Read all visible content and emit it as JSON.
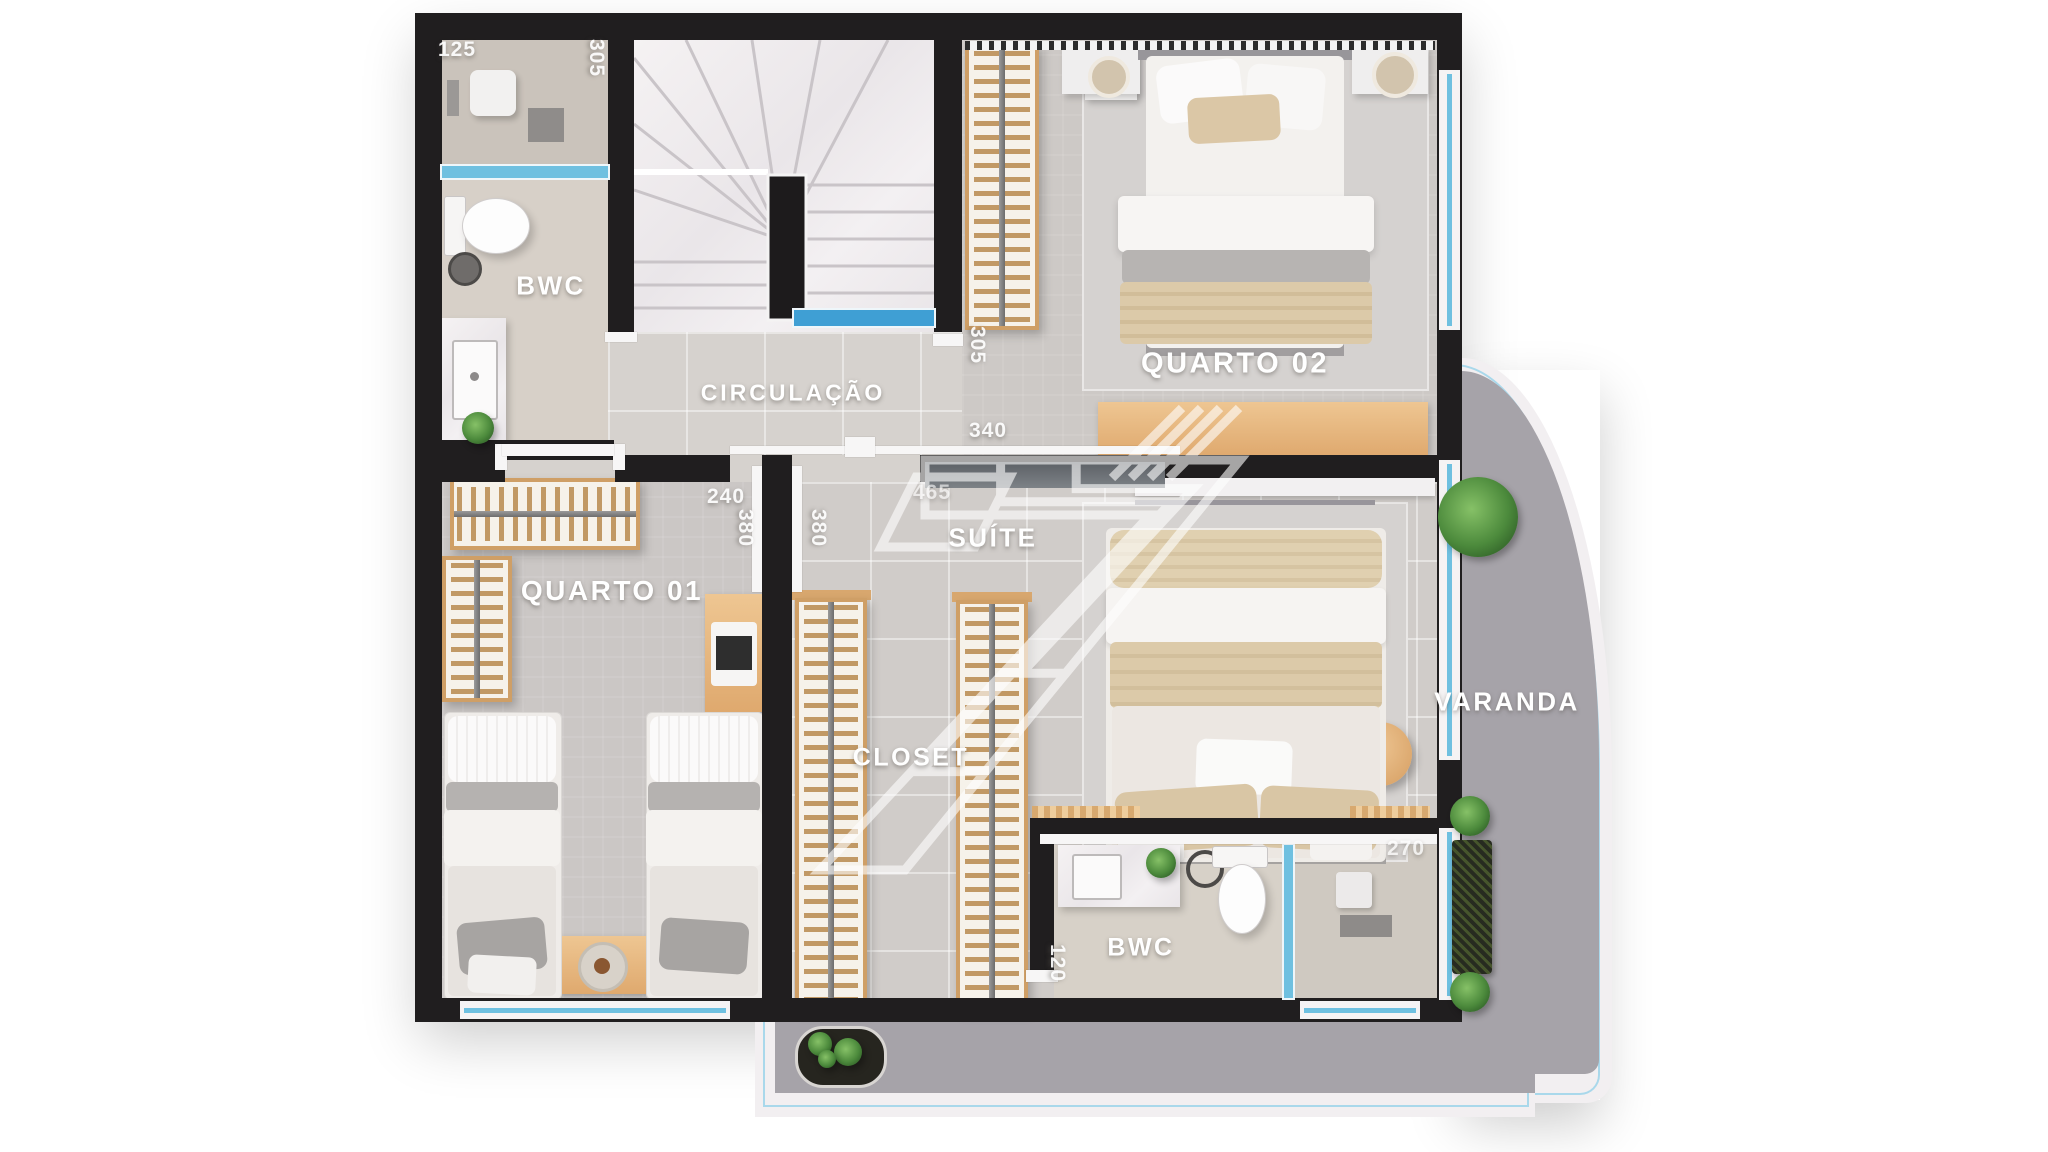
{
  "watermark_glyph": "7",
  "rooms": [
    {
      "key": "bwc_top",
      "label": "BWC"
    },
    {
      "key": "circulacao",
      "label": "CIRCULAÇÃO"
    },
    {
      "key": "quarto_01",
      "label": "QUARTO 01"
    },
    {
      "key": "quarto_02",
      "label": "QUARTO 02"
    },
    {
      "key": "suite",
      "label": "SUÍTE"
    },
    {
      "key": "closet",
      "label": "CLOSET"
    },
    {
      "key": "bwc_suite",
      "label": "BWC"
    },
    {
      "key": "varanda",
      "label": "VARANDA"
    }
  ],
  "dimensions_cm": [
    {
      "key": "bwc_top_width",
      "value": "125"
    },
    {
      "key": "bwc_top_depth",
      "value": "305"
    },
    {
      "key": "stairs_width",
      "value": "305"
    },
    {
      "key": "suite_door_width",
      "value": "340"
    },
    {
      "key": "suite_width",
      "value": "465"
    },
    {
      "key": "hall_passage_width",
      "value": "240"
    },
    {
      "key": "closet_wall_left",
      "value": "380"
    },
    {
      "key": "closet_wall_right",
      "value": "380"
    },
    {
      "key": "suite_bwc_width",
      "value": "270"
    },
    {
      "key": "suite_bwc_door",
      "value": "120"
    }
  ],
  "colors": {
    "wall": "#201e1f",
    "floor_tile": "#d6d2ce",
    "floor_bedroom": "#cdc9c6",
    "marble": "#f1eef0",
    "glass_blue": "#6fc0e0",
    "wood": "#e3b47e",
    "terrace_floor": "#a6a3a9"
  }
}
